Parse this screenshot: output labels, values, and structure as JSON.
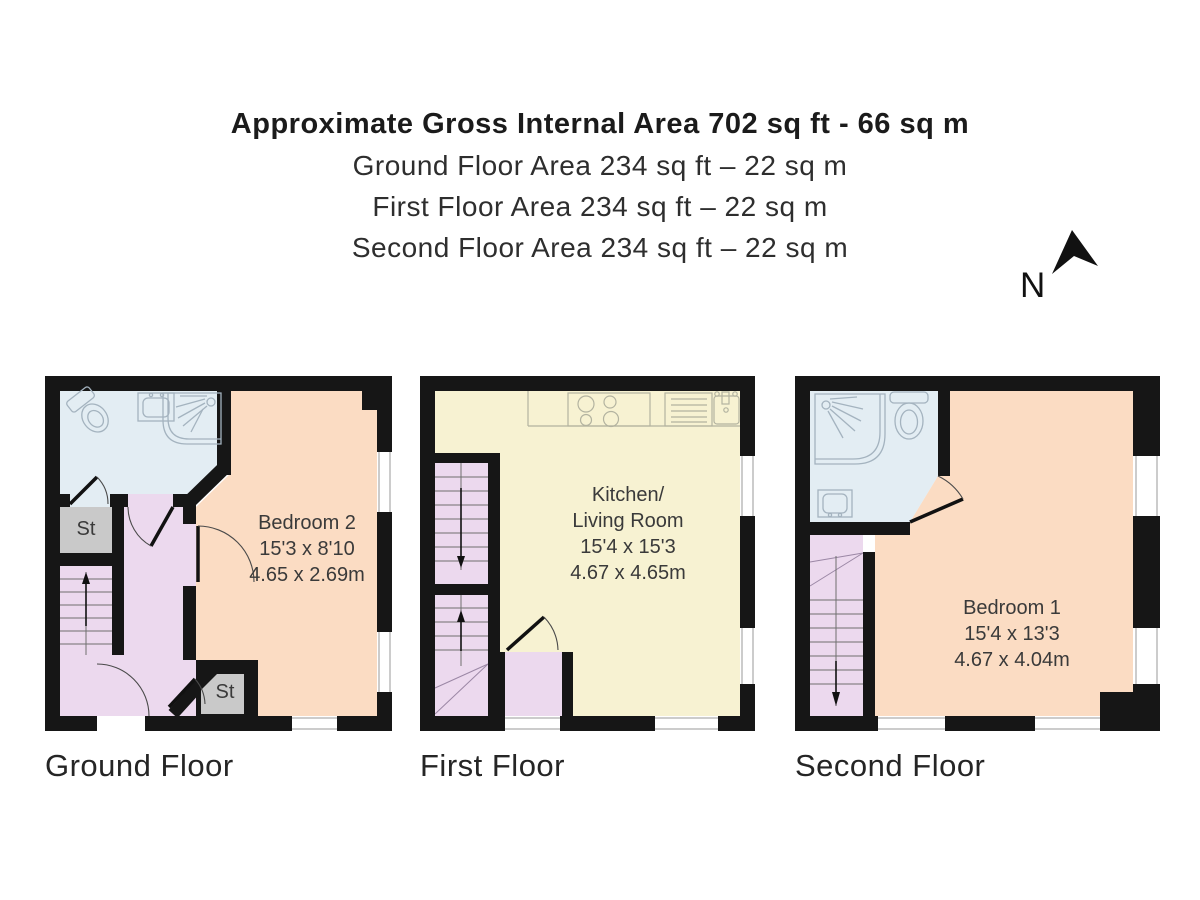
{
  "header": {
    "title": "Approximate Gross Internal Area 702 sq ft - 66 sq m",
    "lines": [
      "Ground Floor Area 234 sq ft – 22 sq m",
      "First Floor Area 234 sq ft – 22 sq m",
      "Second Floor Area 234 sq ft – 22 sq m"
    ]
  },
  "compass": {
    "label": "N"
  },
  "floors": [
    {
      "caption": "Ground Floor",
      "room": {
        "name": "Bedroom 2",
        "size_ft": "15'3 x 8'10",
        "size_m": "4.65 x 2.69m"
      },
      "storage1": "St",
      "storage2": "St"
    },
    {
      "caption": "First Floor",
      "room": {
        "name1": "Kitchen/",
        "name2": "Living Room",
        "size_ft": "15'4 x 15'3",
        "size_m": "4.67 x 4.65m"
      }
    },
    {
      "caption": "Second Floor",
      "room": {
        "name": "Bedroom 1",
        "size_ft": "15'4 x 13'3",
        "size_m": "4.67 x 4.04m"
      }
    }
  ],
  "colors": {
    "wall": "#161616",
    "bathroom": "#e3edf3",
    "bedroom": "#fbdcc3",
    "hall": "#ecd9ee",
    "kitchen": "#f7f2d2",
    "storage": "#c9c9c9",
    "fixture": "#a4b3bf",
    "kfixture": "#b3b3a0"
  }
}
